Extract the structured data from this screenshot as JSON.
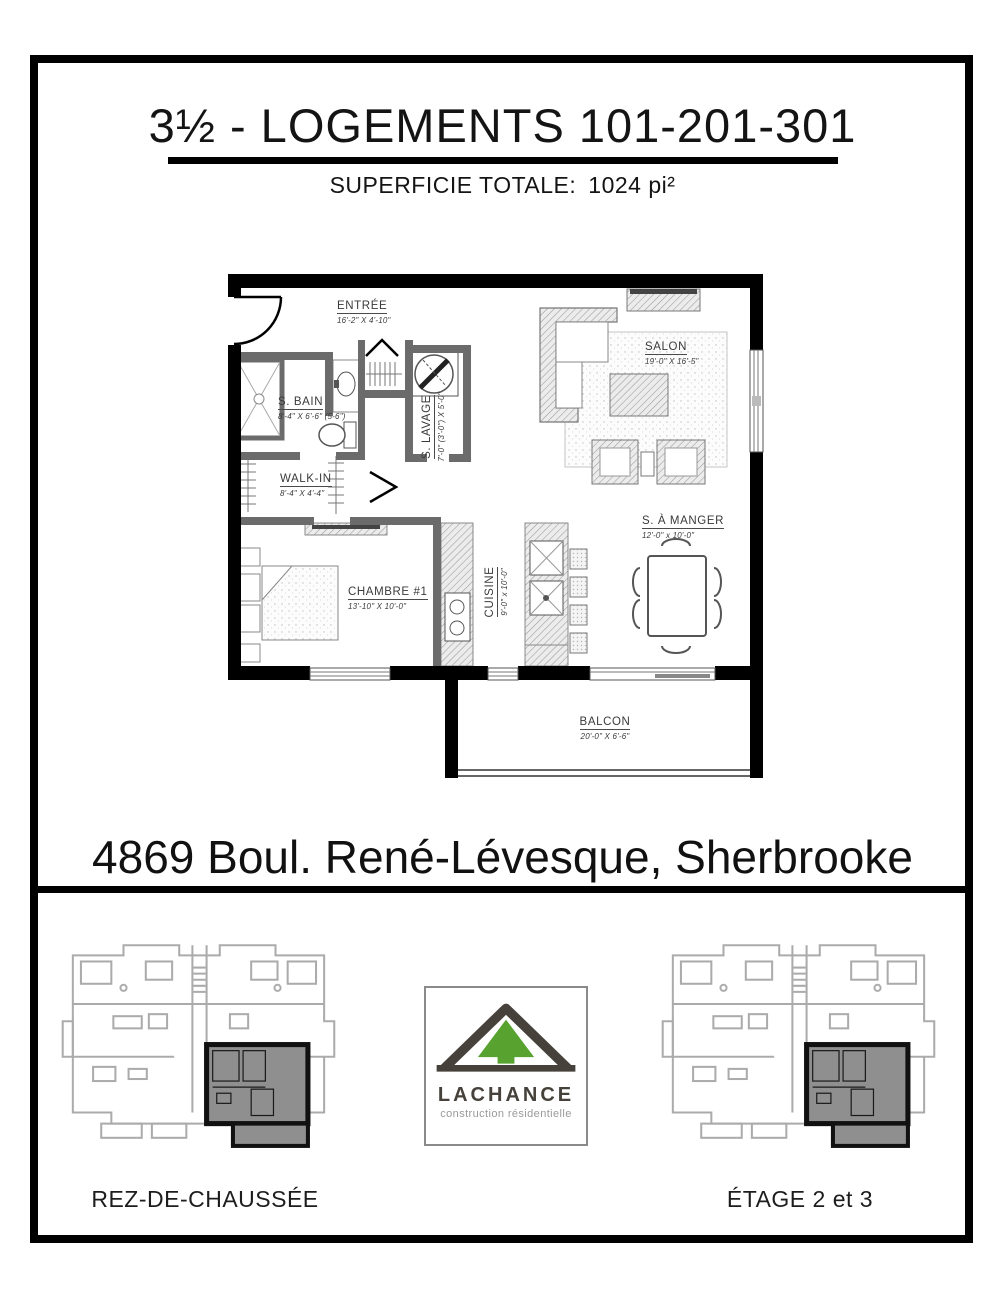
{
  "page": {
    "title": "3½ - LOGEMENTS 101-201-301",
    "subtitle_label": "SUPERFICIE TOTALE:",
    "subtitle_value": "1024 pi²",
    "address": "4869 Boul. René-Lévesque, Sherbrooke"
  },
  "floorplan": {
    "rooms": [
      {
        "name": "ENTRÉE",
        "dims": "16'-2\" X 4'-10\""
      },
      {
        "name": "S. BAIN",
        "dims": "8'-4\" X 6'-6\" (5-6\")"
      },
      {
        "name": "S. LAVAGE",
        "dims": "7'-0\" (3'-0\") X 5'-0\""
      },
      {
        "name": "WALK-IN",
        "dims": "8'-4\" X 4'-4\""
      },
      {
        "name": "CHAMBRE #1",
        "dims": "13'-10\" X 10'-0\""
      },
      {
        "name": "CUISINE",
        "dims": "9'-0\" x 10'-0\""
      },
      {
        "name": "SALON",
        "dims": "19'-0\" X 16'-5\""
      },
      {
        "name": "S. À MANGER",
        "dims": "12'-0\" x 10'-0\""
      },
      {
        "name": "BALCON",
        "dims": "20'-0\" X 6'-6\""
      }
    ]
  },
  "logo": {
    "name": "LACHANCE",
    "tagline": "construction résidentielle",
    "green": "#58a32f",
    "dark": "#46413a"
  },
  "footer": {
    "left_label": "REZ-DE-CHAUSSÉE",
    "right_label": "ÉTAGE 2 et 3"
  },
  "colors": {
    "wall_black": "#000000",
    "interior_wall_grey": "#6b6b6b",
    "highlight_unit_grey": "#8f8f8f",
    "miniplan_grey": "#ababab"
  }
}
